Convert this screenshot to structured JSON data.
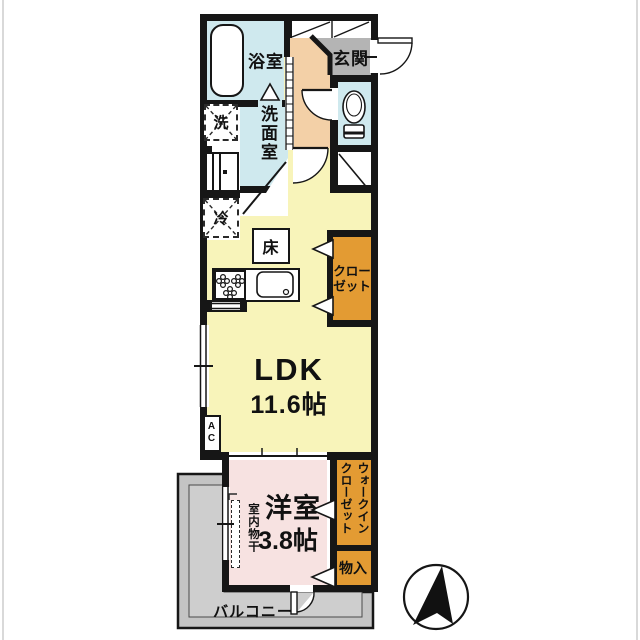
{
  "plan": {
    "type": "japanese-apartment-floor-plan",
    "rooms": {
      "bathroom": {
        "label": "浴室"
      },
      "washroom": {
        "label": "洗面室"
      },
      "entrance": {
        "label": "玄関"
      },
      "ldk": {
        "label": "LDK",
        "size": "11.6帖"
      },
      "western_room": {
        "label": "洋室",
        "size": "3.8帖",
        "note": "室内物干"
      },
      "closet": {
        "label_line1": "クロー",
        "label_line2": "ゼット"
      },
      "walk_in_closet": {
        "label": "ウォークインクローゼット"
      },
      "storage": {
        "label": "物入"
      },
      "balcony": {
        "label": "バルコニー"
      }
    },
    "fixtures": {
      "washing_machine": "洗",
      "refrigerator": "冷",
      "floor_storage_hatch": "床",
      "air_conditioner": "AC"
    },
    "colors": {
      "wall": "#161616",
      "wet_area_blue": "#cfe9ee",
      "hallway_peach": "#f3d0a7",
      "ldk_yellow": "#f8f4ba",
      "bedroom_pink": "#f7e2e1",
      "storage_orange": "#e39b33",
      "entrance_gray": "#b4b4b4",
      "balcony_gray": "#c4c4c4"
    }
  }
}
